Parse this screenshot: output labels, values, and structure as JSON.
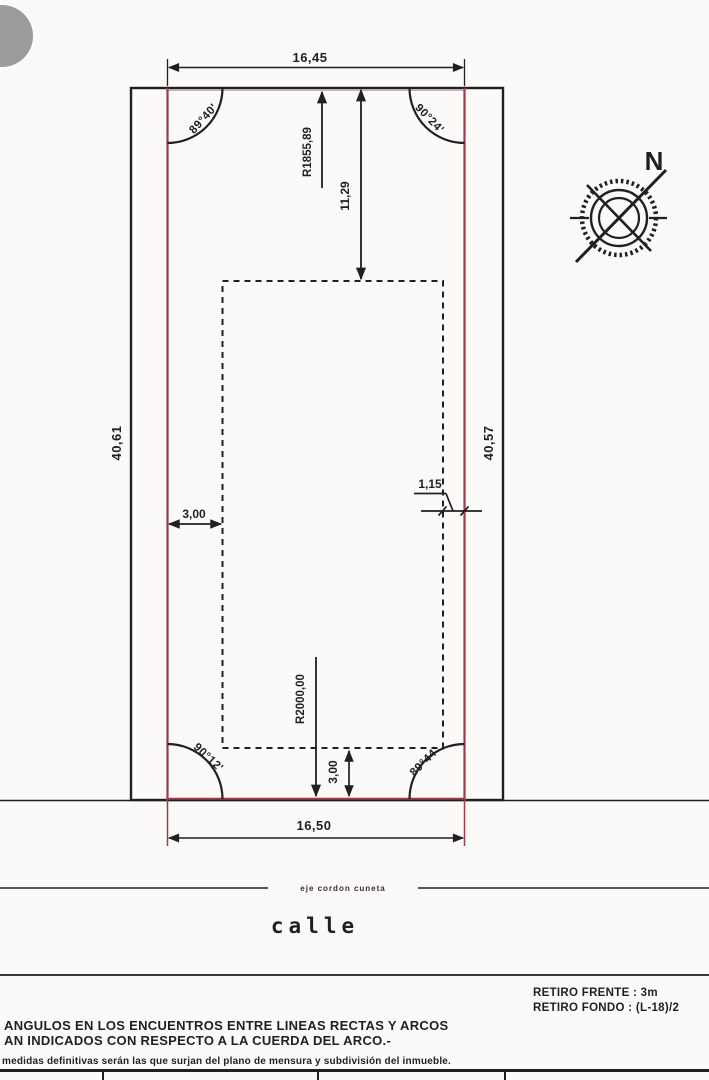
{
  "drawing": {
    "dimensions": {
      "front_top": "16,45",
      "front_bottom": "16,50",
      "side_left": "40,61",
      "side_right": "40,57",
      "radius_front": "R1855,89",
      "depth_to_setback": "11,29",
      "setback_left": "3,00",
      "setback_right": "1,15",
      "radius_rear": "R2000,00",
      "setback_rear": "3,00"
    },
    "angles": {
      "top_left": "89°40'",
      "top_right": "90°24'",
      "bottom_left": "90°12'",
      "bottom_right": "89°44'"
    },
    "compass_label": "N",
    "street_label": "calle",
    "curb_axis_label": "eje cordon cuneta"
  },
  "notes": {
    "retiro_frente": "RETIRO FRENTE : 3m",
    "retiro_fondo": "RETIRO FONDO : (L-18)/2",
    "angles_note_line1": "ANGULOS EN LOS ENCUENTROS ENTRE LINEAS RECTAS Y ARCOS",
    "angles_note_line2": "AN INDICADOS CON RESPECTO A LA CUERDA DEL ARCO.-",
    "measures_note": "medidas definitivas serán las que surjan del plano de mensura y subdivisión del inmueble."
  },
  "colors": {
    "ink": "#211f1f",
    "boundary_red": "#a03a4a",
    "paper": "#fbfaf8",
    "artifact_gray": "#9b9b9b"
  }
}
